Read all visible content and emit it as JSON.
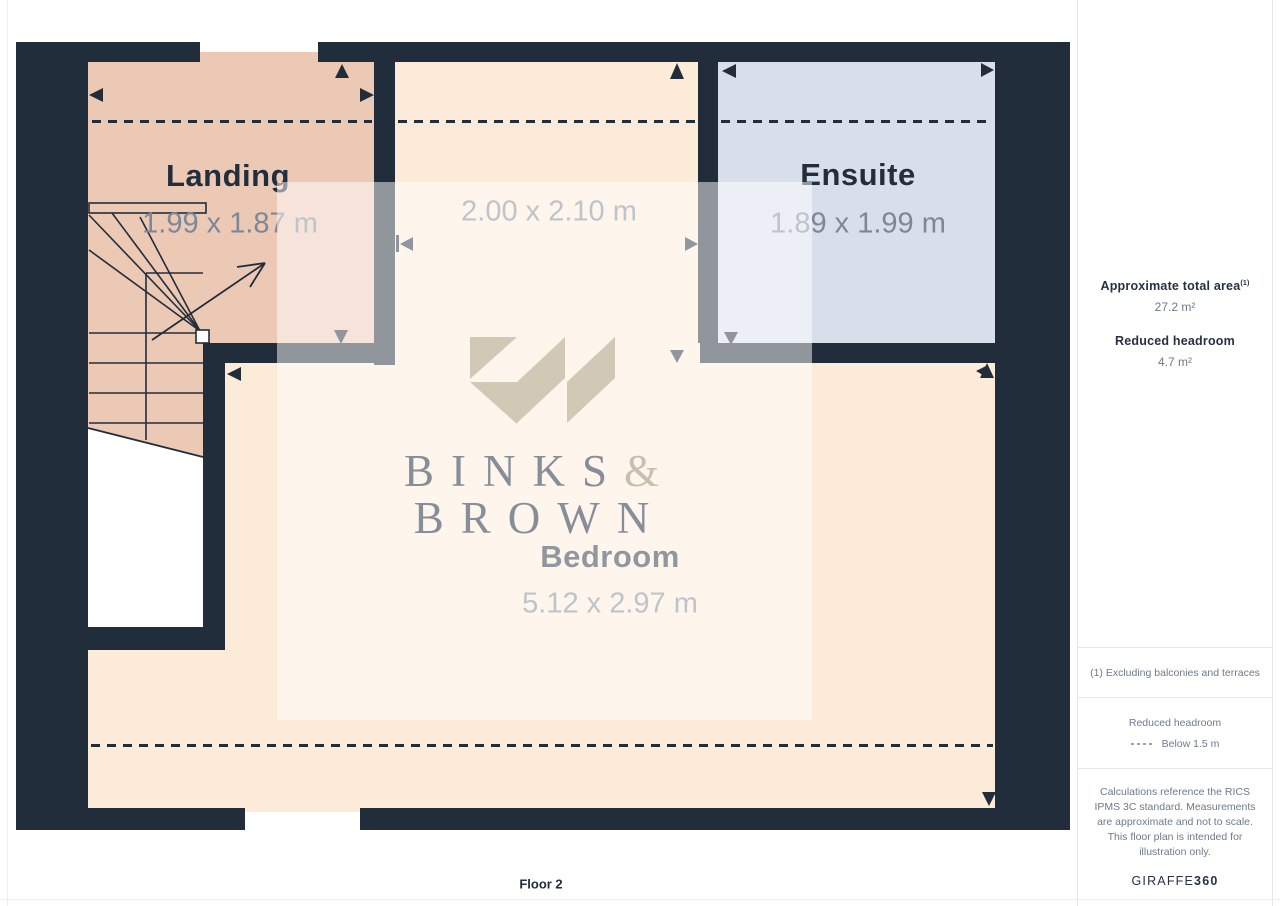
{
  "floor_label": "Floor 2",
  "rooms": [
    {
      "name": "Landing",
      "dimensions": "1.99 x 1.87 m"
    },
    {
      "name": "",
      "dimensions": "2.00 x 2.10 m"
    },
    {
      "name": "Ensuite",
      "dimensions": "1.89 x 1.99 m"
    },
    {
      "name": "Bedroom",
      "dimensions": "5.12 x 2.97 m"
    }
  ],
  "logo": {
    "line1": "BINKS",
    "ampersand": "&",
    "line2": "BROWN"
  },
  "sidebar": {
    "total_area_label": "Approximate total area",
    "total_area_note_ref": "(1)",
    "total_area_value": "27.2 m²",
    "reduced_headroom_label": "Reduced headroom",
    "reduced_headroom_value": "4.7 m²",
    "footnote": "(1) Excluding balconies and terraces",
    "legend_title": "Reduced headroom",
    "legend_item": "Below 1.5 m",
    "disclaimer": "Calculations reference the RICS IPMS 3C standard. Measurements are approximate and not to scale. This floor plan is intended for illustration only.",
    "brand": "GIRAFFE",
    "brand_bold": "360"
  },
  "colors": {
    "wall": "#222d3b",
    "landing_floor": "#ecc9b4",
    "bedroom_floor": "#fdebd9",
    "ensuite_floor": "#d8deea",
    "label_text": "#232e3c",
    "dimension_text": "#7d8798",
    "logo_mark": "#d2c8b6",
    "logo_text": "#878e98",
    "logo_ampersand": "#c9bfad",
    "sidebar_text": "#6e7a8a",
    "sidebar_heading": "#273142"
  }
}
